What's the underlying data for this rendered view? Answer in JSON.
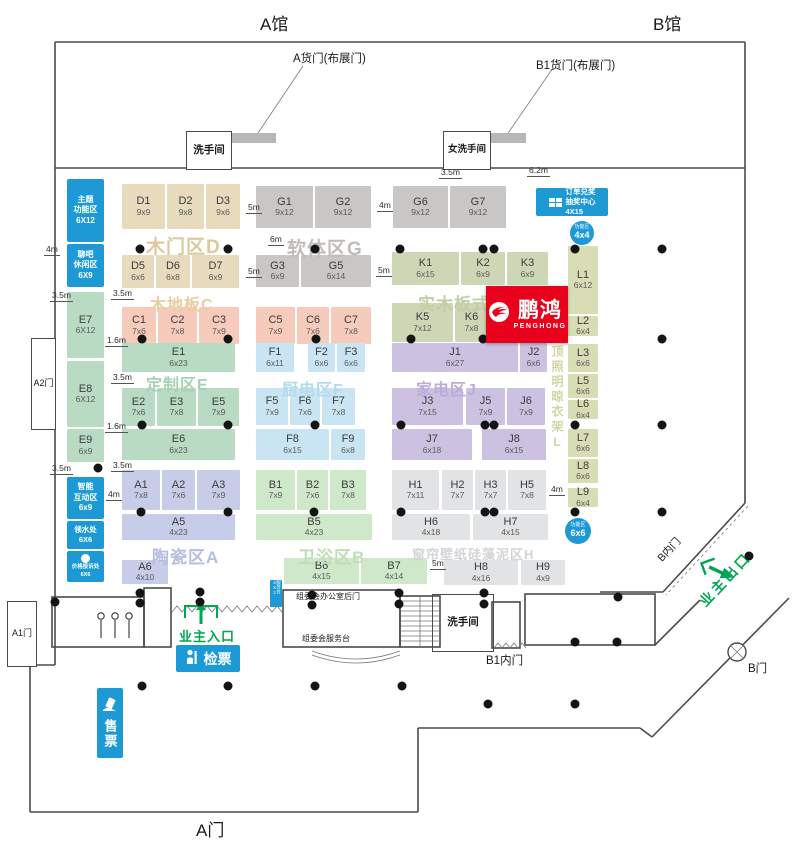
{
  "titles": {
    "hall_a": "A馆",
    "hall_b": "B馆",
    "gate_a": "A门"
  },
  "doors": {
    "cargo_a": "A货门(布展门)",
    "cargo_b1": "B1货门(布展门)"
  },
  "rooms": {
    "washroom_top": "洗手间",
    "washroom_women": "女洗手间",
    "gate_a2": "A2门",
    "gate_a1": "A1门",
    "washroom_bottom": "洗手间",
    "office_backdoor": "组委会办公室后门",
    "service_desk": "组委会服务台",
    "svc_small": "服务台4X3"
  },
  "gates": {
    "b_inner": "B内门",
    "b1_inner": "B1内门",
    "b_gate": "B门",
    "owner_exit": "业主出口",
    "owner_entry": "业主入口",
    "check_ticket": "检票",
    "sell_ticket": "售票"
  },
  "brand": {
    "name": "鹏鸿",
    "latin": "PENGHONG",
    "color": "#e8001d"
  },
  "colors": {
    "blue": "#1d9ad6",
    "green": "#00a651",
    "red": "#e8001d"
  },
  "zones": [
    {
      "id": "D",
      "label": "木门区D",
      "color": "#e8dbbd",
      "label_color": "#dcc99c",
      "label_pos": [
        146,
        232
      ],
      "label_size": 19,
      "booths": [
        {
          "id": "D1",
          "size": "9x9",
          "rect": [
            122,
            184,
            43,
            45
          ]
        },
        {
          "id": "D2",
          "size": "9x8",
          "rect": [
            167,
            184,
            37,
            45
          ]
        },
        {
          "id": "D3",
          "size": "9x6",
          "rect": [
            206,
            184,
            34,
            45
          ]
        },
        {
          "id": "D5",
          "size": "6x6",
          "rect": [
            122,
            255,
            32,
            33
          ]
        },
        {
          "id": "D6",
          "size": "6x8",
          "rect": [
            156,
            255,
            34,
            33
          ]
        },
        {
          "id": "D7",
          "size": "6x9",
          "rect": [
            192,
            255,
            47,
            33
          ]
        }
      ]
    },
    {
      "id": "G",
      "label": "软体区G",
      "color": "#c9c7c5",
      "label_color": "#bfbcb9",
      "label_pos": [
        287,
        234
      ],
      "label_size": 19,
      "booths": [
        {
          "id": "G1",
          "size": "9x12",
          "rect": [
            256,
            186,
            57,
            42
          ]
        },
        {
          "id": "G2",
          "size": "9x12",
          "rect": [
            315,
            186,
            56,
            42
          ]
        },
        {
          "id": "G6",
          "size": "9x12",
          "rect": [
            393,
            186,
            55,
            42
          ]
        },
        {
          "id": "G7",
          "size": "9x12",
          "rect": [
            450,
            186,
            56,
            42
          ]
        },
        {
          "id": "G3",
          "size": "6x9",
          "rect": [
            256,
            255,
            43,
            32
          ]
        },
        {
          "id": "G5",
          "size": "6x14",
          "rect": [
            301,
            255,
            70,
            32
          ]
        }
      ]
    },
    {
      "id": "K",
      "label": "实木板式K",
      "color": "#cdd7b5",
      "label_color": "#c2cfa5",
      "label_pos": [
        418,
        290
      ],
      "label_size": 17,
      "booths": [
        {
          "id": "K1",
          "size": "6x15",
          "rect": [
            392,
            252,
            67,
            33
          ]
        },
        {
          "id": "K2",
          "size": "6x9",
          "rect": [
            461,
            252,
            44,
            33
          ]
        },
        {
          "id": "K3",
          "size": "6x9",
          "rect": [
            507,
            252,
            41,
            33
          ]
        },
        {
          "id": "K5",
          "size": "7x12",
          "rect": [
            392,
            303,
            61,
            39
          ]
        },
        {
          "id": "K6",
          "size": "7x8",
          "rect": [
            455,
            303,
            33,
            39
          ]
        }
      ]
    },
    {
      "id": "C",
      "label": "木地板C",
      "color": "#f7cbbc",
      "label_color": "#e9cd9e",
      "label_pos": [
        150,
        291
      ],
      "label_size": 16,
      "booths": [
        {
          "id": "C1",
          "size": "7x6",
          "rect": [
            122,
            307,
            34,
            37
          ]
        },
        {
          "id": "C2",
          "size": "7x8",
          "rect": [
            158,
            307,
            39,
            37
          ]
        },
        {
          "id": "C3",
          "size": "7x9",
          "rect": [
            199,
            307,
            40,
            37
          ]
        },
        {
          "id": "C5",
          "size": "7x9",
          "rect": [
            256,
            307,
            39,
            37
          ]
        },
        {
          "id": "C6",
          "size": "7x6",
          "rect": [
            297,
            307,
            32,
            37
          ]
        },
        {
          "id": "C7",
          "size": "7x8",
          "rect": [
            331,
            307,
            40,
            37
          ]
        }
      ]
    },
    {
      "id": "E",
      "label": "定制区E",
      "color": "#b9dbc3",
      "label_color": "#a6d2b3",
      "label_pos": [
        146,
        371
      ],
      "label_size": 16,
      "booths": [
        {
          "id": "E7",
          "size": "6X12",
          "rect": [
            67,
            292,
            37,
            66
          ]
        },
        {
          "id": "E8",
          "size": "6X12",
          "rect": [
            67,
            361,
            37,
            66
          ]
        },
        {
          "id": "E9",
          "size": "6x9",
          "rect": [
            67,
            429,
            37,
            33
          ]
        },
        {
          "id": "E1",
          "size": "6x23",
          "rect": [
            122,
            343,
            113,
            29
          ]
        },
        {
          "id": "E2",
          "size": "7x6",
          "rect": [
            122,
            388,
            33,
            38
          ]
        },
        {
          "id": "E3",
          "size": "7x8",
          "rect": [
            157,
            388,
            39,
            38
          ]
        },
        {
          "id": "E5",
          "size": "7x9",
          "rect": [
            198,
            388,
            41,
            38
          ]
        },
        {
          "id": "E6",
          "size": "6x23",
          "rect": [
            122,
            429,
            113,
            31
          ]
        }
      ]
    },
    {
      "id": "F",
      "label": "厨电区F",
      "color": "#c9e5f3",
      "label_color": "#b3dbee",
      "label_pos": [
        282,
        376
      ],
      "label_size": 16,
      "booths": [
        {
          "id": "F1",
          "size": "6x11",
          "rect": [
            256,
            343,
            38,
            29
          ]
        },
        {
          "id": "F2",
          "size": "6x6",
          "rect": [
            308,
            343,
            27,
            29
          ]
        },
        {
          "id": "F3",
          "size": "6x6",
          "rect": [
            337,
            343,
            28,
            29
          ]
        },
        {
          "id": "F5",
          "size": "7x9",
          "rect": [
            256,
            388,
            32,
            37
          ]
        },
        {
          "id": "F6",
          "size": "7x6",
          "rect": [
            290,
            388,
            30,
            37
          ]
        },
        {
          "id": "F7",
          "size": "7x8",
          "rect": [
            322,
            388,
            33,
            37
          ]
        },
        {
          "id": "F8",
          "size": "6x15",
          "rect": [
            256,
            429,
            73,
            31
          ]
        },
        {
          "id": "F9",
          "size": "6x8",
          "rect": [
            331,
            429,
            34,
            31
          ]
        }
      ]
    },
    {
      "id": "J",
      "label": "家电区J",
      "color": "#ccc1e1",
      "label_color": "#bbadd8",
      "label_pos": [
        416,
        376
      ],
      "label_size": 16,
      "booths": [
        {
          "id": "J1",
          "size": "6x27",
          "rect": [
            392,
            343,
            126,
            29
          ]
        },
        {
          "id": "J2",
          "size": "6x6",
          "rect": [
            520,
            343,
            27,
            29
          ]
        },
        {
          "id": "J3",
          "size": "7x15",
          "rect": [
            392,
            388,
            71,
            37
          ]
        },
        {
          "id": "J5",
          "size": "7x9",
          "rect": [
            466,
            388,
            39,
            37
          ]
        },
        {
          "id": "J6",
          "size": "7x9",
          "rect": [
            507,
            388,
            38,
            37
          ]
        },
        {
          "id": "J7",
          "size": "6x18",
          "rect": [
            392,
            429,
            80,
            31
          ]
        },
        {
          "id": "J8",
          "size": "6x15",
          "rect": [
            482,
            429,
            64,
            31
          ]
        }
      ]
    },
    {
      "id": "A",
      "label": "陶瓷区A",
      "color": "#c7cde8",
      "label_color": "#b5bede",
      "label_pos": [
        152,
        543
      ],
      "label_size": 17,
      "booths": [
        {
          "id": "A1",
          "size": "7x8",
          "rect": [
            122,
            470,
            38,
            40
          ]
        },
        {
          "id": "A2",
          "size": "7x6",
          "rect": [
            162,
            470,
            33,
            40
          ]
        },
        {
          "id": "A3",
          "size": "7x9",
          "rect": [
            197,
            470,
            43,
            40
          ]
        },
        {
          "id": "A5",
          "size": "4x23",
          "rect": [
            122,
            514,
            113,
            26
          ]
        },
        {
          "id": "A6",
          "size": "4x10",
          "rect": [
            122,
            560,
            46,
            24
          ]
        }
      ]
    },
    {
      "id": "B",
      "label": "卫浴区B",
      "color": "#cfe8c9",
      "label_color": "#bddfb6",
      "label_pos": [
        298,
        543
      ],
      "label_size": 17,
      "booths": [
        {
          "id": "B1",
          "size": "7x9",
          "rect": [
            256,
            470,
            39,
            40
          ]
        },
        {
          "id": "B2",
          "size": "7x6",
          "rect": [
            297,
            470,
            31,
            40
          ]
        },
        {
          "id": "B3",
          "size": "7x8",
          "rect": [
            330,
            470,
            36,
            40
          ]
        },
        {
          "id": "B5",
          "size": "4x23",
          "rect": [
            256,
            514,
            116,
            26
          ]
        },
        {
          "id": "B6",
          "size": "4x15",
          "rect": [
            284,
            558,
            75,
            26
          ]
        },
        {
          "id": "B7",
          "size": "4x14",
          "rect": [
            361,
            558,
            66,
            26
          ]
        }
      ]
    },
    {
      "id": "H",
      "label": "窗帘壁纸硅藻泥区H",
      "color": "#e2e3e5",
      "label_color": "#d2d4d7",
      "label_pos": [
        412,
        544
      ],
      "label_size": 13,
      "booths": [
        {
          "id": "H1",
          "size": "7x11",
          "rect": [
            392,
            470,
            47,
            40
          ]
        },
        {
          "id": "H2",
          "size": "7x7",
          "rect": [
            442,
            470,
            31,
            40
          ]
        },
        {
          "id": "H3",
          "size": "7x7",
          "rect": [
            475,
            470,
            31,
            40
          ]
        },
        {
          "id": "H5",
          "size": "7x8",
          "rect": [
            508,
            470,
            38,
            40
          ]
        },
        {
          "id": "H6",
          "size": "4x18",
          "rect": [
            392,
            514,
            78,
            26
          ]
        },
        {
          "id": "H7",
          "size": "4x15",
          "rect": [
            473,
            514,
            75,
            26
          ]
        },
        {
          "id": "H8",
          "size": "4x16",
          "rect": [
            444,
            560,
            74,
            25
          ]
        },
        {
          "id": "H9",
          "size": "4x9",
          "rect": [
            521,
            560,
            44,
            25
          ]
        }
      ]
    },
    {
      "id": "L",
      "label": "吊顶照明晾衣架L",
      "color": "#d9ddb6",
      "label_color": "#d0d6a2",
      "label_pos": [
        549,
        330
      ],
      "label_size": 12,
      "vertical": true,
      "booths": [
        {
          "id": "L1",
          "size": "6x12",
          "rect": [
            568,
            246,
            30,
            68
          ]
        },
        {
          "id": "L2",
          "size": "6x4",
          "rect": [
            568,
            316,
            30,
            20
          ]
        },
        {
          "id": "L3",
          "size": "6x6",
          "rect": [
            568,
            344,
            30,
            28
          ]
        },
        {
          "id": "L5",
          "size": "6x6",
          "rect": [
            568,
            374,
            30,
            24
          ]
        },
        {
          "id": "L6",
          "size": "6x4",
          "rect": [
            568,
            400,
            30,
            19
          ]
        },
        {
          "id": "L7",
          "size": "6x6",
          "rect": [
            568,
            429,
            30,
            28
          ]
        },
        {
          "id": "L8",
          "size": "6x6",
          "rect": [
            568,
            459,
            30,
            24
          ]
        },
        {
          "id": "L9",
          "size": "6x4",
          "rect": [
            568,
            488,
            30,
            19
          ]
        }
      ]
    }
  ],
  "services": [
    {
      "id": "theme-zone",
      "lines": [
        "主题",
        "功能区",
        "6X12"
      ],
      "rect": [
        67,
        179,
        37,
        63
      ],
      "fs": 8
    },
    {
      "id": "chat-lounge",
      "lines": [
        "聊吧",
        "休闲区",
        "6X9"
      ],
      "rect": [
        67,
        244,
        37,
        43
      ],
      "fs": 8
    },
    {
      "id": "smart-interactive",
      "lines": [
        "智能",
        "互动区",
        "6x9"
      ],
      "rect": [
        67,
        477,
        37,
        42
      ],
      "fs": 8
    },
    {
      "id": "water-station",
      "lines": [
        "领水处",
        "6X6"
      ],
      "rect": [
        67,
        521,
        37,
        28
      ],
      "fs": 7.5
    },
    {
      "id": "price-complaint",
      "lines": [
        "价格投诉处",
        "6X6"
      ],
      "rect": [
        67,
        551,
        37,
        31
      ],
      "fs": 5.5,
      "icon": "cup"
    },
    {
      "id": "order-lottery",
      "lines": [
        "订单兑奖",
        "抽奖中心",
        "4X15"
      ],
      "rect": [
        536,
        188,
        72,
        28
      ],
      "fs": 7.5,
      "icon": "gift",
      "horizontal": true
    }
  ],
  "circles": [
    {
      "label": "功能区",
      "size": "4x4",
      "cx": 582,
      "cy": 233,
      "r": 12
    },
    {
      "label": "功能区",
      "size": "6x6",
      "cx": 578,
      "cy": 531,
      "r": 13
    }
  ],
  "dims": [
    {
      "t": "4m",
      "x": 44,
      "y": 245
    },
    {
      "t": "3.5m",
      "x": 50,
      "y": 291
    },
    {
      "t": "3.5m",
      "x": 111,
      "y": 289
    },
    {
      "t": "5m",
      "x": 246,
      "y": 203
    },
    {
      "t": "5m",
      "x": 246,
      "y": 267
    },
    {
      "t": "6m",
      "x": 268,
      "y": 235
    },
    {
      "t": "4m",
      "x": 377,
      "y": 201
    },
    {
      "t": "5m",
      "x": 376,
      "y": 266
    },
    {
      "t": "3.5m",
      "x": 439,
      "y": 168
    },
    {
      "t": "6.2m",
      "x": 527,
      "y": 166
    },
    {
      "t": "1.6m",
      "x": 105,
      "y": 336
    },
    {
      "t": "3.5m",
      "x": 111,
      "y": 373
    },
    {
      "t": "1.6m",
      "x": 105,
      "y": 422
    },
    {
      "t": "3.5m",
      "x": 50,
      "y": 464
    },
    {
      "t": "3.5m",
      "x": 111,
      "y": 461
    },
    {
      "t": "4m",
      "x": 106,
      "y": 490
    },
    {
      "t": "4m",
      "x": 549,
      "y": 485
    },
    {
      "t": "5m",
      "x": 430,
      "y": 559
    }
  ],
  "dots": [
    [
      140,
      249
    ],
    [
      228,
      249
    ],
    [
      315,
      249
    ],
    [
      400,
      249
    ],
    [
      483,
      249
    ],
    [
      494,
      249
    ],
    [
      575,
      249
    ],
    [
      662,
      249
    ],
    [
      142,
      339
    ],
    [
      228,
      339
    ],
    [
      316,
      339
    ],
    [
      411,
      339
    ],
    [
      483,
      339
    ],
    [
      662,
      339
    ],
    [
      142,
      425
    ],
    [
      228,
      425
    ],
    [
      315,
      425
    ],
    [
      401,
      425
    ],
    [
      485,
      425
    ],
    [
      494,
      425
    ],
    [
      575,
      425
    ],
    [
      662,
      425
    ],
    [
      141,
      512
    ],
    [
      228,
      512
    ],
    [
      314,
      512
    ],
    [
      401,
      512
    ],
    [
      485,
      512
    ],
    [
      494,
      512
    ],
    [
      575,
      512
    ],
    [
      662,
      512
    ],
    [
      98,
      468
    ],
    [
      55,
      602
    ],
    [
      749,
      556
    ],
    [
      140,
      593
    ],
    [
      140,
      603
    ],
    [
      200,
      592
    ],
    [
      200,
      602
    ],
    [
      312,
      595
    ],
    [
      312,
      605
    ],
    [
      399,
      593
    ],
    [
      399,
      604
    ],
    [
      484,
      593
    ],
    [
      484,
      604
    ],
    [
      618,
      597
    ],
    [
      575,
      642
    ],
    [
      617,
      642
    ],
    [
      142,
      686
    ],
    [
      228,
      686
    ],
    [
      315,
      686
    ],
    [
      402,
      686
    ],
    [
      488,
      704
    ],
    [
      575,
      704
    ]
  ]
}
